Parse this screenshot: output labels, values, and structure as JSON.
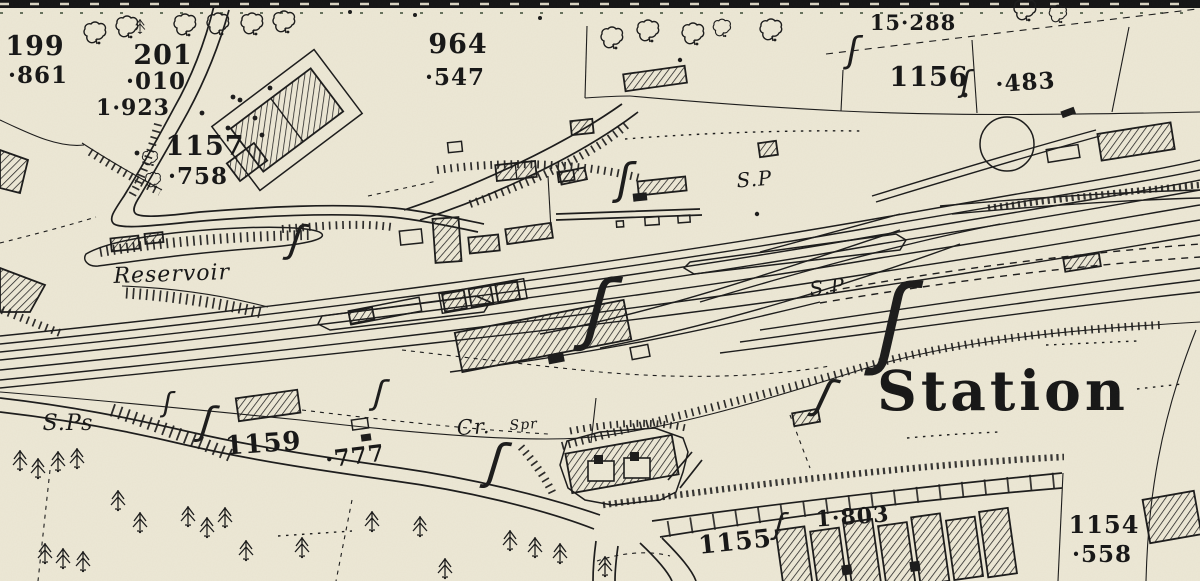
{
  "map": {
    "colors": {
      "paper": "#ece7d5",
      "ink": "#1b1b1b"
    },
    "symbols": {
      "brace": "ʃ",
      "building_fill": "diagonal-hatch",
      "turntable": "circle",
      "deciduous_tree": "cloud-outline",
      "conifer_tree": "spiky-fir"
    },
    "labels": {
      "parcel_199": {
        "num": "199",
        "area": "·861"
      },
      "parcel_201": {
        "num": "201",
        "area": "·010"
      },
      "plot_1923": "1·923",
      "parcel_1157": {
        "num": "1157",
        "area": "·758"
      },
      "parcel_964": {
        "num": "964",
        "area": "·547"
      },
      "plot_15288": "15·288",
      "parcel_1156": {
        "num": "1156",
        "area": "·483"
      },
      "reservoir": "Reservoir",
      "signal_post_upper": "S.P",
      "signal_post_lower": "S.P",
      "signal_posts": "S.Ps",
      "parcel_1159": {
        "num": "1159",
        "area": "·777"
      },
      "crane": "Cr.",
      "spring": "Spr",
      "station": "Station",
      "parcel_1155": "1155",
      "plot_1803": "1·803",
      "parcel_1154": {
        "num": "1154",
        "area": "·558"
      }
    }
  }
}
